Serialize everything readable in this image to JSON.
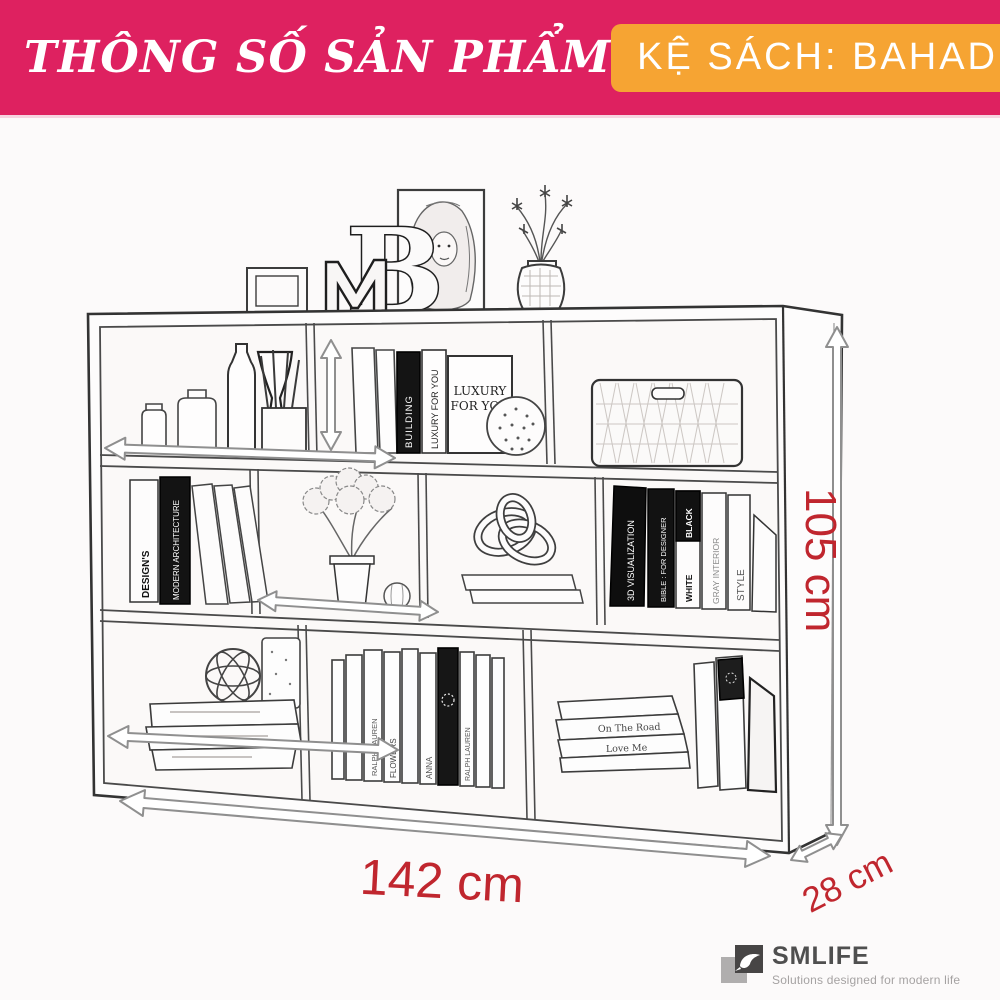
{
  "header": {
    "title": "THÔNG SỐ SẢN PHẨM",
    "bg_color": "#de2160",
    "badge": {
      "label": "KỆ SÁCH: BAHADUR",
      "bg_color": "#f6a433"
    }
  },
  "dimensions": {
    "width": "142 cm",
    "height": "105 cm",
    "depth": "28 cm",
    "accent_color": "#c0262e"
  },
  "illustration": {
    "spines": {
      "building": "BUILDING",
      "luxury_spine": "LUXURY FOR YOU",
      "luxury_cover_line1": "LUXURY",
      "luxury_cover_line2": "FOR YOU",
      "designs": "DESIGN'S",
      "modern_architecture": "MODERN ARCHITECTURE",
      "visualization_3d": "3D VISUALIZATION",
      "bible_for_designer": "BIBLE : FOR DESIGNER",
      "white": "WHITE",
      "black": "BLACK",
      "gray_interior": "GRAY INTERIOR",
      "style": "STYLE",
      "anna": "ANNA",
      "ralph_lauren": "RALPH LAUREN",
      "flowers": "FLOWERS",
      "on_the_road": "On The Road",
      "love_me": "Love Me"
    }
  },
  "footer": {
    "brand": "SMLIFE",
    "tagline": "Solutions designed for modern life"
  }
}
